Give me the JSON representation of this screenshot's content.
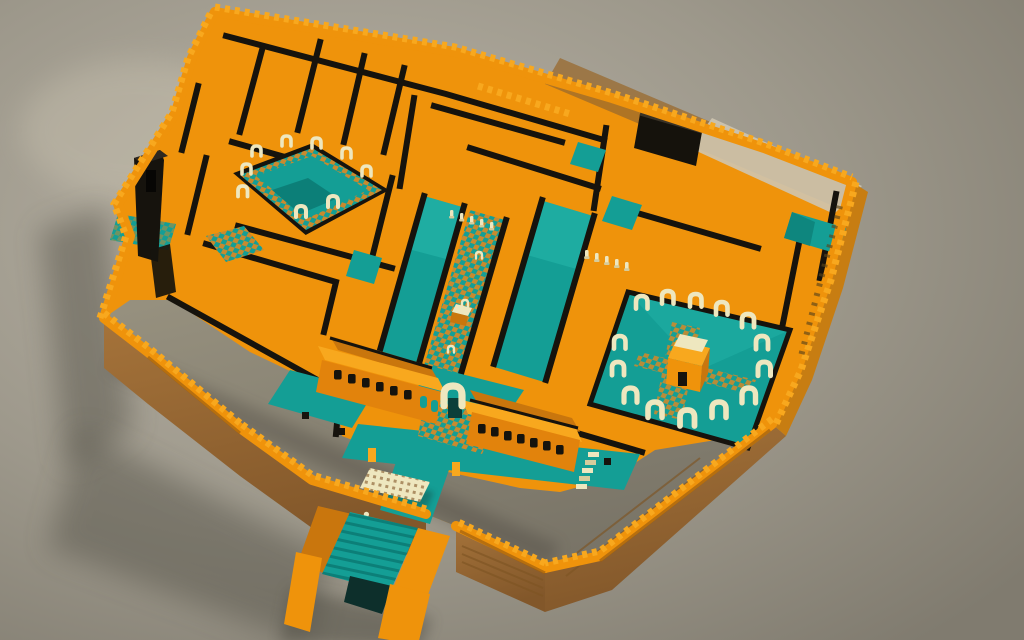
{
  "meta": {
    "title": "Isometric voxel-art palace complex - 3D render",
    "style": "low-poly voxel / blocky 3D render, no text or UI elements",
    "camera": "high-angle three-quarter view, sunlight from upper right, soft shadow cast to lower left"
  },
  "palette": {
    "bg1": "#b9b3a6",
    "bg2": "#9d988b",
    "bg3": "#807b6f",
    "orange": "#ef930b",
    "orangeLight": "#f8a81e",
    "orangeDark": "#c9760d",
    "orangeDeep": "#a05f10",
    "brown": "#a5733a",
    "brownDark": "#82572a",
    "black": "#16130d",
    "blackSoft": "#2e2820",
    "teal": "#149e95",
    "tealLight": "#24b4a8",
    "tealDark": "#0c7f78",
    "tealDeep": "#0b3f3a",
    "cream": "#eee7bf",
    "creamShade": "#d6cc9c",
    "checkerOrange": "#c98a2e",
    "ground": "#8e897c",
    "litFace": "#cec5b0",
    "shadow": "#4a463e"
  },
  "scene": {
    "description": "A walled desert palace rendered in voxel style: orange crenellated ramparts enclose a maze of rooms with black wall tops, turquoise courtyards and long pillared halls with checkerboard paths, rings of cream horseshoe arches around two courtyards (the right one holds a small orange pavilion), a twin gatehouse with dark windows and a cream entrance arch on the south side, a pergola terrace with two small statues, and a grand turquoise staircase descending through the south wall. A tall black tower stands at the west, a dark roofless room sits near the north wall, and the south yard inside the wall is bare grey ground.",
    "elements": [
      "background-ground-plane",
      "cast-shadow",
      "outer-crenellated-wall",
      "exterior-wall-faces",
      "inner-grey-yard",
      "orange-room-platform",
      "black-wall-top-lines",
      "black-tower",
      "dark-room",
      "west-mini-courtyard",
      "left-arch-courtyard-with-pool",
      "central-halls-with-checker-path",
      "throne-object",
      "column-rows",
      "right-arch-courtyard-with-pavilion",
      "north-east-teal-pool",
      "gatehouse-left-building",
      "gatehouse-right-building",
      "gate-arch",
      "checker-plaza",
      "south-terraces",
      "pergola",
      "statues",
      "entrance-staircase",
      "terrace-steps"
    ]
  }
}
